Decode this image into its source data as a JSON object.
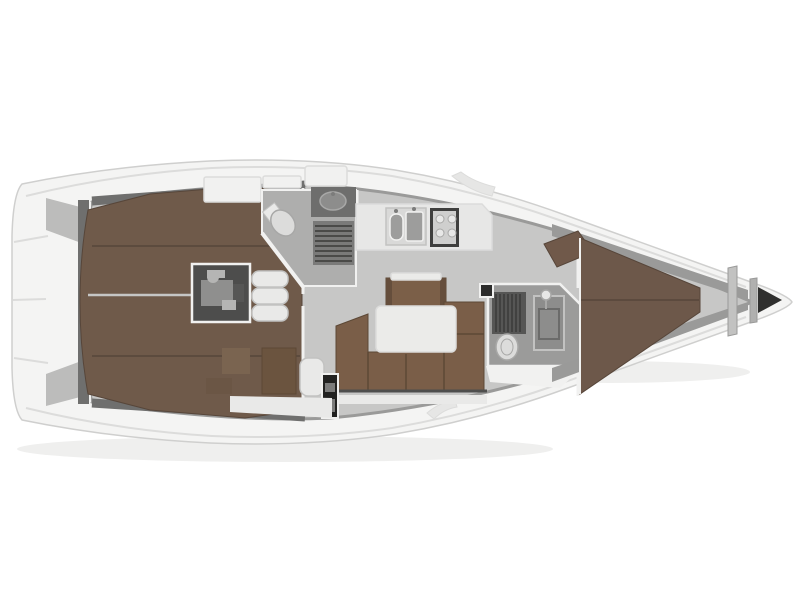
{
  "figure": {
    "type": "yacht-deck-plan",
    "view": "top-down",
    "bow_direction": "right",
    "regions": [
      "stern-swim-platform",
      "aft-double-cabin-port",
      "aft-double-cabin-starboard",
      "engine-compartment",
      "companionway-steps",
      "aft-heads-with-shower",
      "galley-twin-sinks-and-stove",
      "saloon-u-settee-and-table",
      "navigation-station",
      "forward-heads-with-shower",
      "forward-v-berth-cabin",
      "anchor-locker"
    ]
  },
  "colors": {
    "bg": "#ffffff",
    "shadow": "#efefee",
    "hull": "#f4f4f3",
    "hullLine": "#cfcfce",
    "deckSeam": "#dcdcdb",
    "floor": "#c7c7c6",
    "wallDark": "#6f6f6e",
    "wallMid": "#9a9a99",
    "wallLight": "#f1f1f0",
    "angledWall": "#bcbcbb",
    "roomGray": "#aeaead",
    "roomGrayDark": "#9b9b9a",
    "berth": "#6f5a4a",
    "berthSeam": "#57463a",
    "salonSofa": "#7a5e48",
    "salonSeam": "#5c4836",
    "island": "#7b5f48",
    "islandShade": "#654e3c",
    "navBrown": "#6b543f",
    "navDoor": "#7a6450",
    "navBox": "#6b5645",
    "cornerSeat": "#70594a",
    "vberth": "#6d584a",
    "table": "#ebebe9",
    "counter": "#e7e7e6",
    "counterDark": "#6e6e6d",
    "sinkUnit": "#d9d9d8",
    "sinkBasin": "#9d9d9c",
    "sinkOval": "#8d8d8c",
    "stoveFrame": "#3f3f3e",
    "stoveTop": "#cfcfce",
    "burner": "#e8e8e7",
    "engineBox": "#4d4d4c",
    "engineMetal": "#8f8f8e",
    "engineMetalLight": "#b5b5b4",
    "steps": "#e9e9e8",
    "stepEdge": "#c2c2c1",
    "panelBlack": "#222221",
    "panelSlot": "#7c7c7b",
    "grate": "#565655",
    "grateLine": "#3a3a39",
    "grateAft": "#7a7a79",
    "toilet": "#dcdcdb",
    "toiletEdge": "#a8a8a7",
    "showerDoor": "#8d8d8c",
    "showerFrame": "#6b6b6a",
    "locker": "#2f2f2e",
    "bulkheadBar": "#c2c2c1",
    "bulkheadBar2": "#b0b0af",
    "whiteBox": "#f1f1f0",
    "plinth": "#e9e9e8",
    "notch": "#e6e6e5",
    "centerGap": "#c6c6c5",
    "benchShadow": "#4e4e4d",
    "latch": "#2c2c2b"
  }
}
